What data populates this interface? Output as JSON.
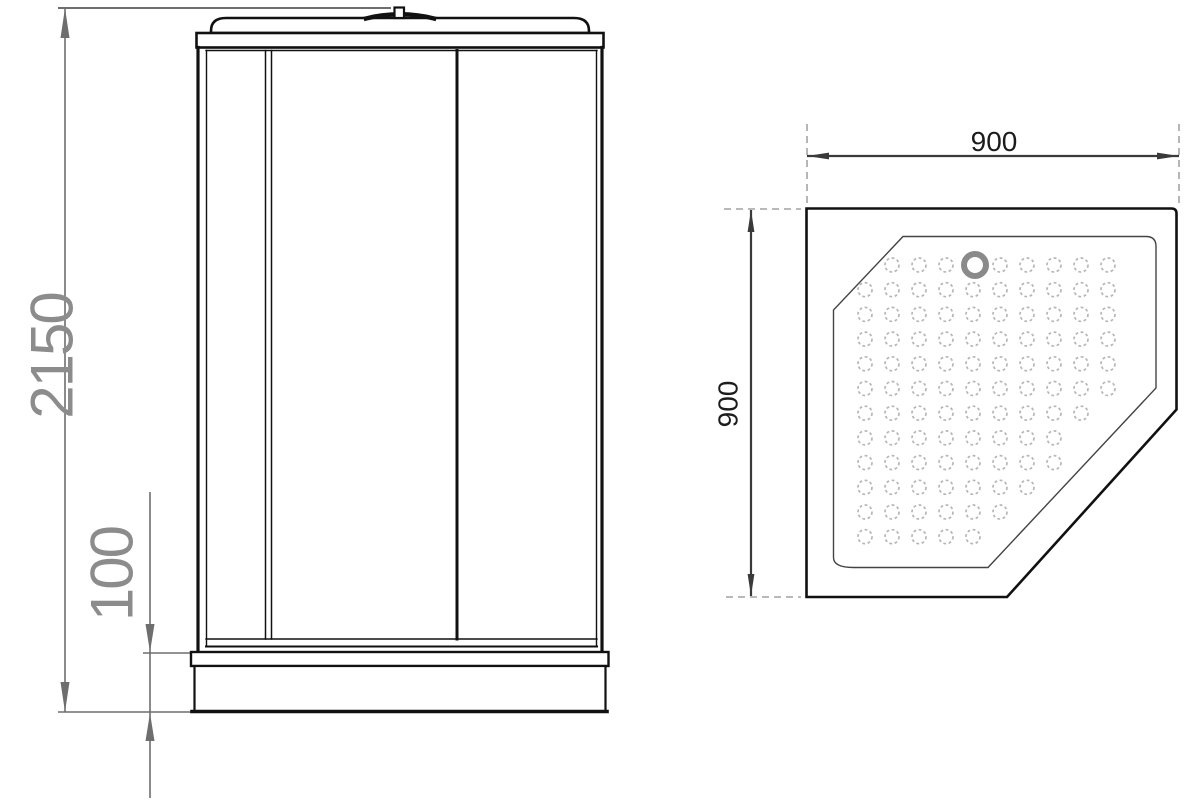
{
  "front_view": {
    "overall_height": "2150",
    "tray_height": "100"
  },
  "top_view": {
    "width": "900",
    "depth": "900",
    "dot_grid": {
      "origin_x": 865,
      "origin_y": 265,
      "cols": 10,
      "rows": 12,
      "dx": 27,
      "dy": 24.7,
      "radius": 7,
      "drain_col": 4
    },
    "drain": {
      "cx": 975,
      "cy": 265,
      "r": 11,
      "stroke_width": 6
    }
  },
  "colors": {
    "background": "#ffffff",
    "line": "#111111",
    "dim_front": "#6e6e6e",
    "text_front": "#8c8c8c",
    "dim_top": "#3a3a3a",
    "text_top": "#1c1c1c",
    "extension": "#8f8f8f",
    "dots": "#b6b6b6",
    "drain": "#8a8a8a"
  }
}
